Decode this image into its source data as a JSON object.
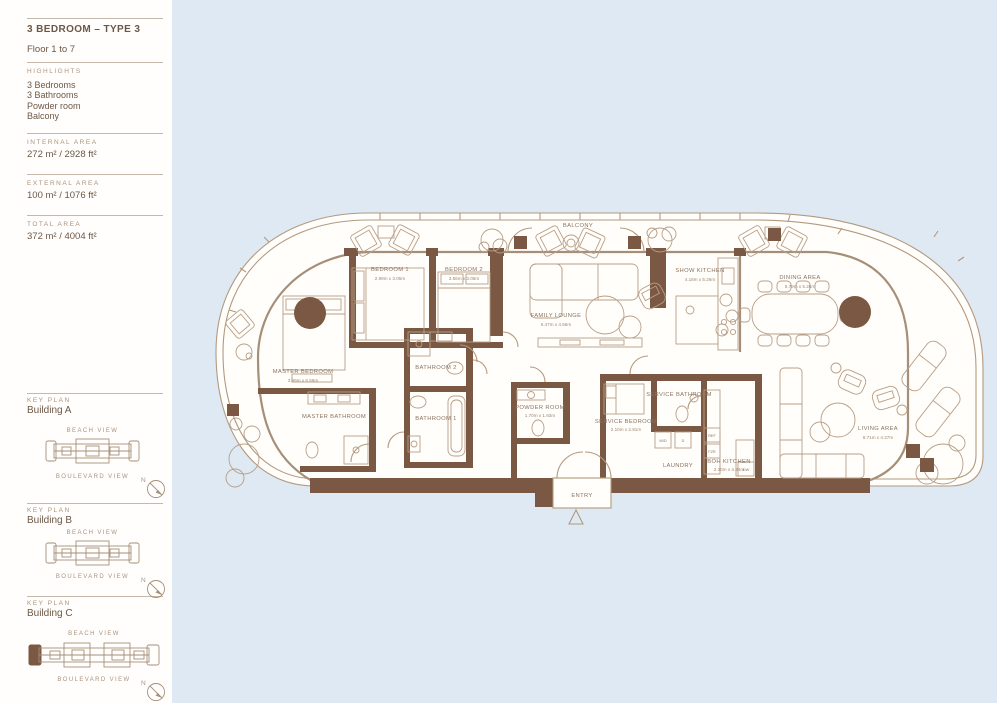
{
  "sidebar": {
    "title": "3 BEDROOM – TYPE 3",
    "floor": "Floor 1 to 7",
    "highlights_label": "HIGHLIGHTS",
    "highlights": [
      "3 Bedrooms",
      "3 Bathrooms",
      "Powder room",
      "Balcony"
    ],
    "areas": [
      {
        "label": "INTERNAL AREA",
        "value": "272 m² / 2928 ft²"
      },
      {
        "label": "EXTERNAL AREA",
        "value": "100 m² / 1076 ft²"
      },
      {
        "label": "TOTAL AREA",
        "value": "372 m² / 4004 ft²"
      }
    ],
    "key_plans": [
      {
        "section_label": "KEY PLAN",
        "building": "Building A",
        "top_view": "BEACH VIEW",
        "bottom_view": "BOULEVARD VIEW",
        "compass": "N",
        "unit_highlighted": false
      },
      {
        "section_label": "KEY PLAN",
        "building": "Building B",
        "top_view": "BEACH VIEW",
        "bottom_view": "BOULEVARD VIEW",
        "compass": "N",
        "unit_highlighted": false
      },
      {
        "section_label": "KEY PLAN",
        "building": "Building C",
        "top_view": "BEACH VIEW",
        "bottom_view": "BOULEVARD VIEW",
        "compass": "N",
        "unit_highlighted": true
      }
    ]
  },
  "floor_plan": {
    "balcony_label": "BALCONY",
    "entry_label": "ENTRY",
    "rooms": [
      {
        "name": "BEDROOM 1",
        "dims": "2.99m x 3.05m"
      },
      {
        "name": "BEDROOM 2",
        "dims": "3.56m x 3.05m"
      },
      {
        "name": "FAMILY LOUNGE",
        "dims": "6.47m x 4.56m"
      },
      {
        "name": "SHOW KITCHEN",
        "dims": "4.18m x 5.26m"
      },
      {
        "name": "DINING AREA",
        "dims": "6.79m x 5.26m"
      },
      {
        "name": "LIVING AREA",
        "dims": "6.71m x 4.27m"
      },
      {
        "name": "MASTER BEDROOM",
        "dims": "3.99m x 5.59m"
      },
      {
        "name": "MASTER BATHROOM",
        "dims": ""
      },
      {
        "name": "BATHROOM 1",
        "dims": ""
      },
      {
        "name": "BATHROOM 2",
        "dims": ""
      },
      {
        "name": "POWDER ROOM",
        "dims": "1.70m x 1.93m"
      },
      {
        "name": "SERVICE BEDROOM",
        "dims": "2.10m x 2.91m"
      },
      {
        "name": "SERVICE BATHROOM",
        "dims": ""
      },
      {
        "name": "LAUNDRY",
        "dims": ""
      },
      {
        "name": "BOH KITCHEN",
        "dims": "2.30m x 4.34m"
      }
    ],
    "appliances": [
      "W/D",
      "D",
      "REF",
      "FZR",
      "DW"
    ]
  },
  "colors": {
    "wall": "#7a5843",
    "line": "#b3997f",
    "label_text": "#8a7360",
    "heading_text": "#6b5746",
    "muted_text": "#a8937e",
    "background": "#dee9f4"
  }
}
